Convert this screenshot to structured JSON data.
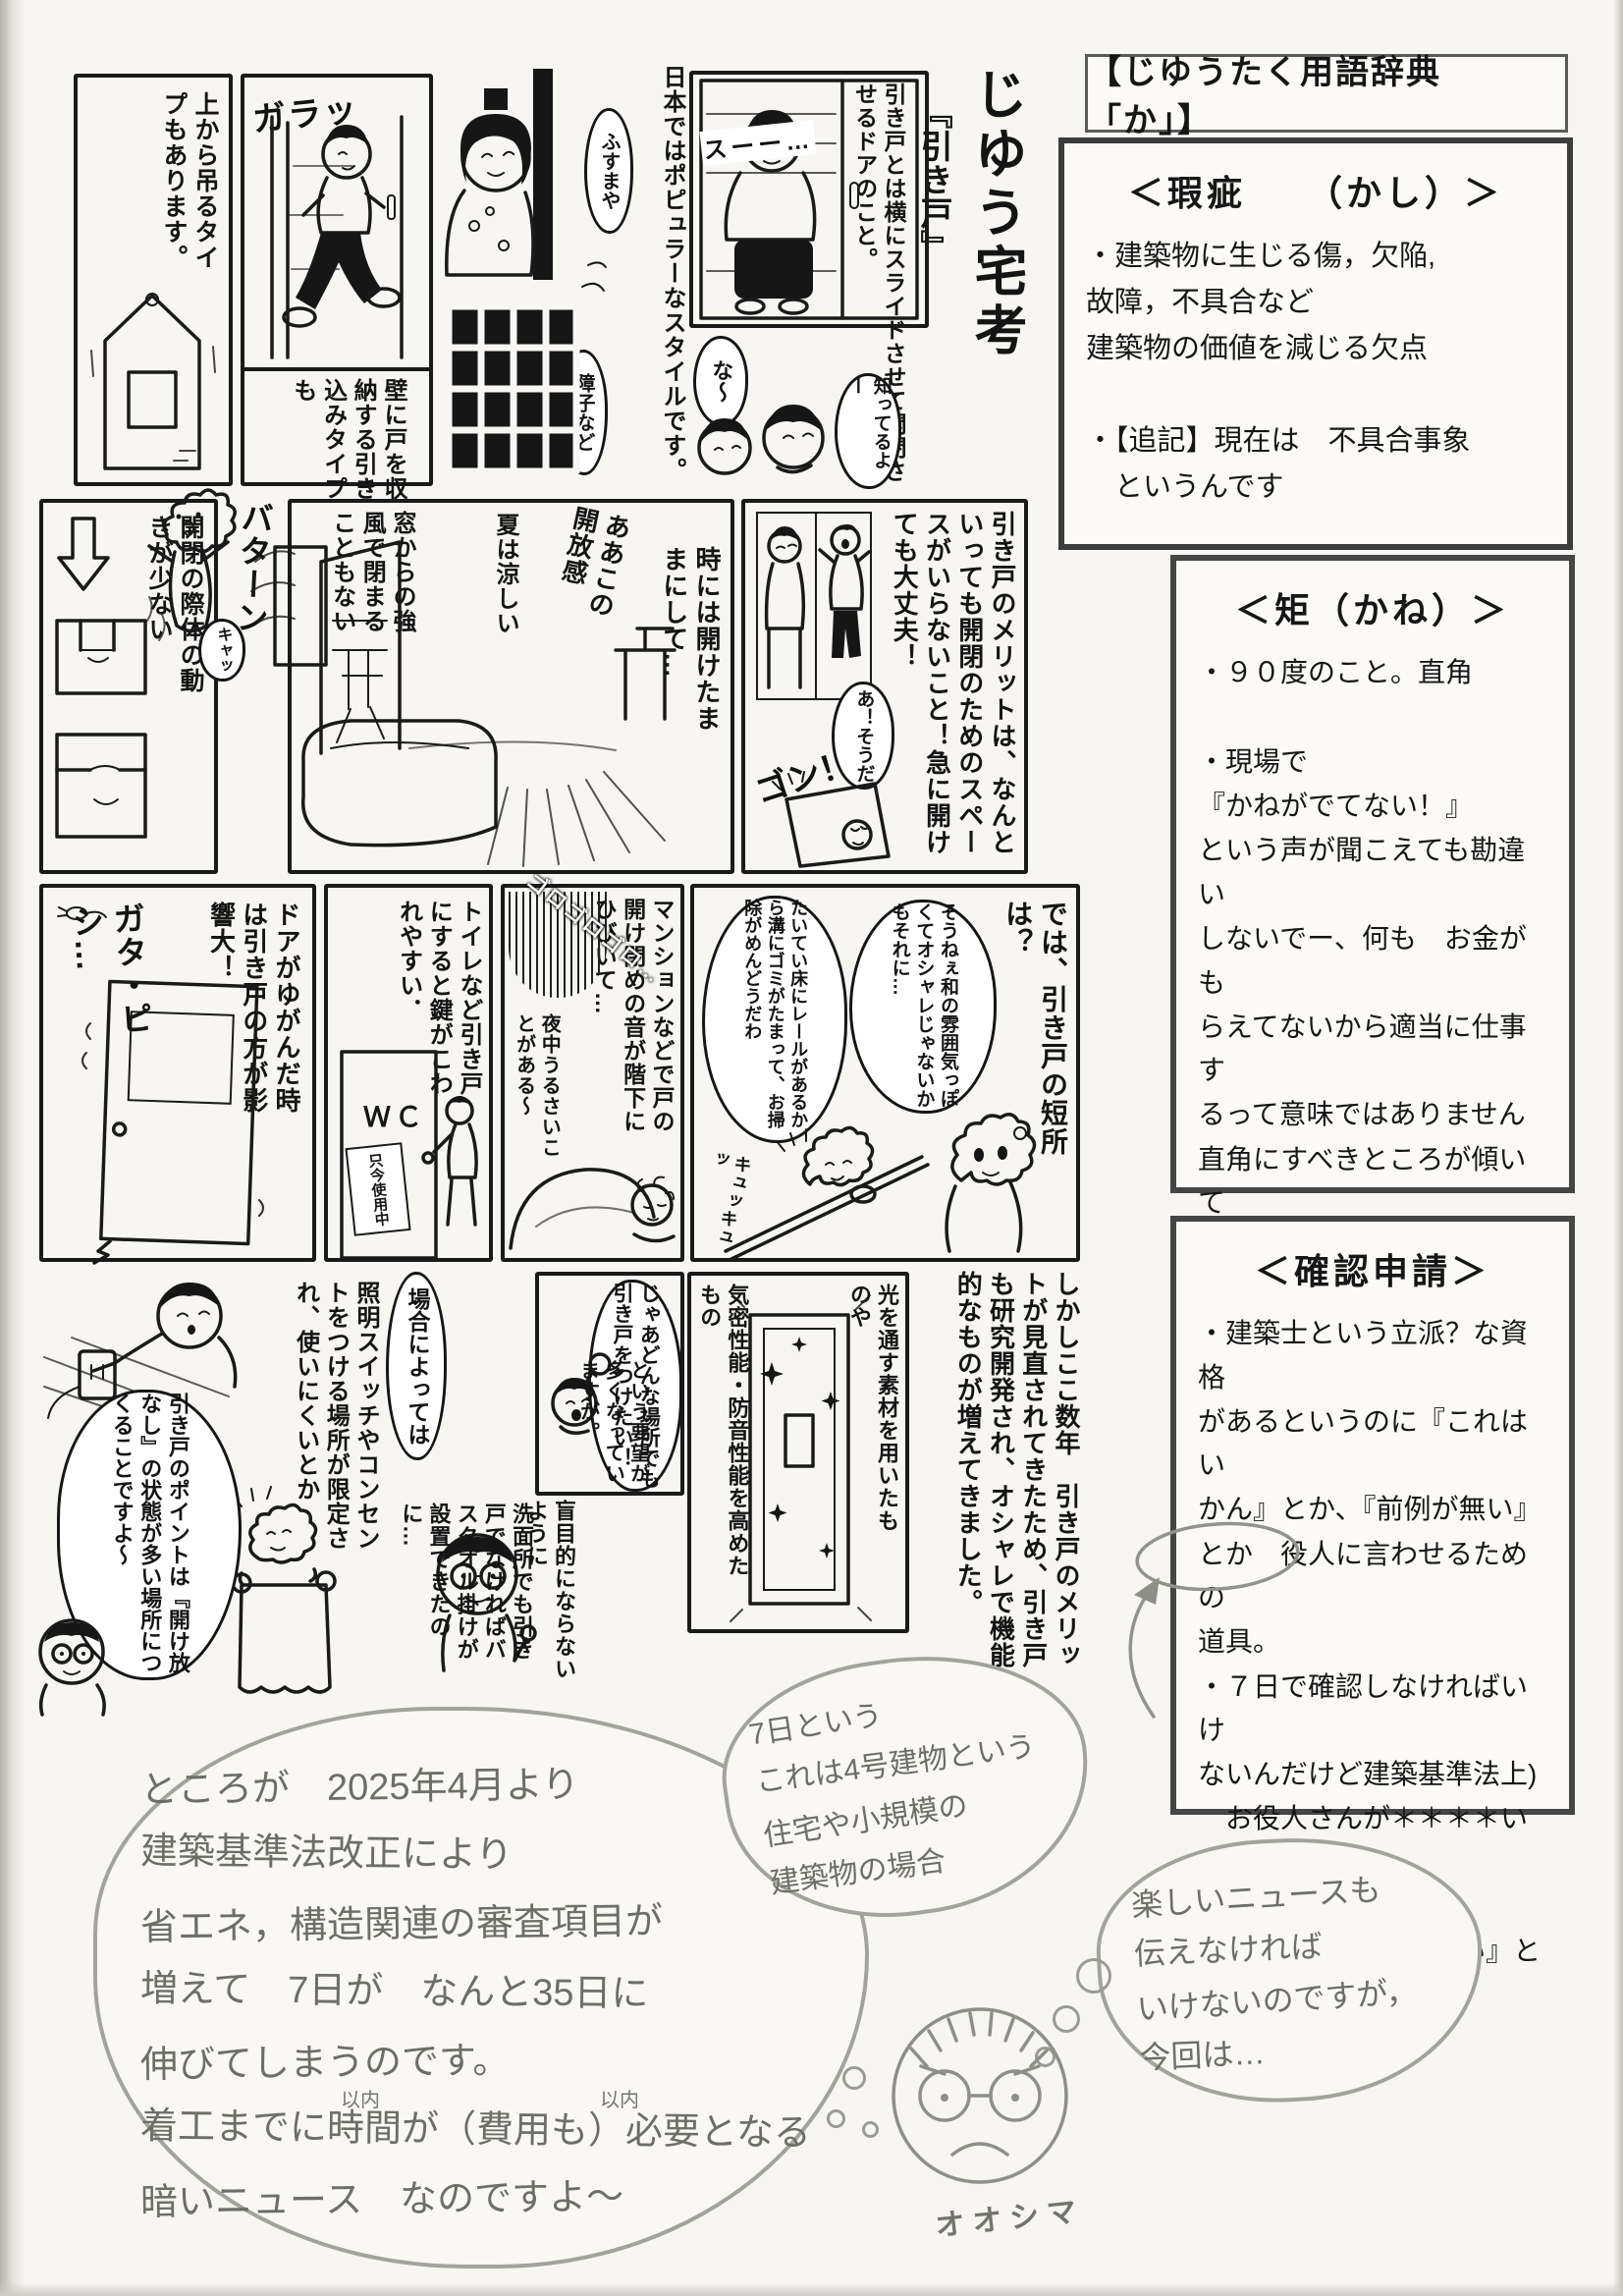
{
  "header_box": {
    "title": "【じゆうたく用語辞典　「か」】"
  },
  "term_boxes": {
    "kashi": {
      "title": "＜瑕疵　　（かし）＞",
      "lines": [
        "・建築物に生じる傷，欠陥,",
        "故障，不具合など",
        "建築物の価値を減じる欠点",
        "",
        "・【追記】現在は　不具合事象",
        "　というんです"
      ]
    },
    "kane": {
      "title": "＜矩（かね）＞",
      "lines": [
        "・９０度のこと。直角",
        "",
        "・現場で",
        "『かねがでてない！』",
        "という声が聞こえても勘違い",
        "しないでー、何も　お金がも",
        "らえてないから適当に仕事す",
        "るって意味ではありません",
        "直角にすべきところが傾いて",
        "たりずれていて納まるべき材",
        "料が収まらない　という意味",
        "なのです"
      ]
    },
    "kakunin": {
      "title": "＜確認申請＞",
      "lines": [
        "・建築士という立派？な資格",
        "があるというのに『これはい",
        "かん』とか、『前例が無い』",
        "とか　役人に言わせるための",
        "道具。",
        "・７日で確認しなければいけ",
        "ないんだけど建築基準法上)",
        "　お役人さんが＊＊＊＊い時",
        "重箱の隅をつついて",
        "　『役所に来てください』と",
        "いえば済む物"
      ]
    }
  },
  "comic": {
    "title_panel": {
      "series": "じゆう宅考",
      "episode": "『引き戸』",
      "intro": "引き戸とは横にスライドさせて開閉させるドアのこと。"
    },
    "panels": {
      "hanging": {
        "caption": "上から吊るタイプもあります。"
      },
      "garatto": {
        "sfx": "ガラッ",
        "caption": "壁に戸を収納する引き込みタイプも"
      },
      "fusuma": {
        "bubble1": "ふすまや",
        "bubble2": "障子など",
        "caption": "日本ではポピュラーなスタイルです。"
      },
      "glassdoor": {
        "sfx": "スーー…",
        "bubble1": "な〜",
        "bubble2": "知ってるよー"
      },
      "kaihei": {
        "caption": "開閉の際体の動きが少ない"
      },
      "wind": {
        "sfx": "バターン",
        "bubble": "キャッ",
        "caption": "窓からの強風で閉まることもない"
      },
      "living": {
        "caption1": "夏は涼しい",
        "caption2": "ああこの開放感",
        "caption3": "時には開けたままにして…"
      },
      "merit": {
        "caption": "引き戸のメリットは、なんといっても開閉のためのスペースがいらないこと！急に開けても大丈夫！",
        "bubble": "あ！そうだ",
        "sfx": "ゴン！"
      },
      "warp": {
        "caption": "ドアがゆがんだ時は引き戸の方が影響大！",
        "sfx": "ガタ・ピシ…"
      },
      "wc": {
        "caption": "トイレなど引き戸にすると鍵がこわれやすい．",
        "sign1": "ＷＣ",
        "sign2": "只今使用中"
      },
      "mansion": {
        "caption": "マンションなどで戸の開け閉めの音が階下にひびいて…",
        "sfx": "ゴロゴロゴロ…",
        "caption2": "夜中うるさいことがある〜"
      },
      "tansho": {
        "question": "では、引き戸の短所は？",
        "bubble1": "そうねぇ和の雰囲気っぽくてオシャレじゃないかもそれに…",
        "bubble2": "たいてい床にレールがあるから溝にゴミがたまって、お掃除がめんどうだわ",
        "sfx": "キュッキュッ"
      },
      "kenkyu": {
        "caption": "しかしここ数年　引き戸のメリットが見直されてきたため、引き戸も研究開発され、オシャレで機能的なものが増えてきました。"
      },
      "sparkle": {
        "caption1": "光を通す素材を用いたものや",
        "caption2": "気密性能・防音性能を高めたもの"
      },
      "fist": {
        "bubble": "じゃあどんな場所でも引き戸をつけたい！",
        "caption": "という要望が多くなっていますが。"
      },
      "caution": {
        "caption": "盲目的にならないように"
      },
      "washroom": {
        "caption": "洗面所でも引き戸でなければバスタオル掛けが設置できたのに…"
      },
      "outlet": {
        "bubble1": "場合によっては",
        "caption": "照明スイッチやコンセントをつける場所が限定され、使いにくいとか",
        "bubble2": "引き戸のポイントは『開け放なし』の状態が多い場所につくることですよ〜"
      }
    }
  },
  "handwritten": {
    "news": {
      "lines": [
        "ところが　2025年4月より",
        "建築基準法改正により",
        "省エネ，構造関連の審査項目が",
        "増えて　7日が　なんと35日に",
        "伸びてしまうのです。",
        "着工までに時間が（費用も）必要となる",
        "暗いニュース　なのですよ〜"
      ],
      "note1": "以内",
      "note2": "以内"
    },
    "gou4": {
      "lines": [
        "7日という",
        "これは4号建物という",
        "住宅や小規模の",
        "建築物の場合"
      ]
    },
    "tanoshii": {
      "lines": [
        "楽しいニュースも",
        "伝えなければ",
        "いけないのですが，",
        "今回は…"
      ]
    },
    "signature": "オオシマ"
  }
}
